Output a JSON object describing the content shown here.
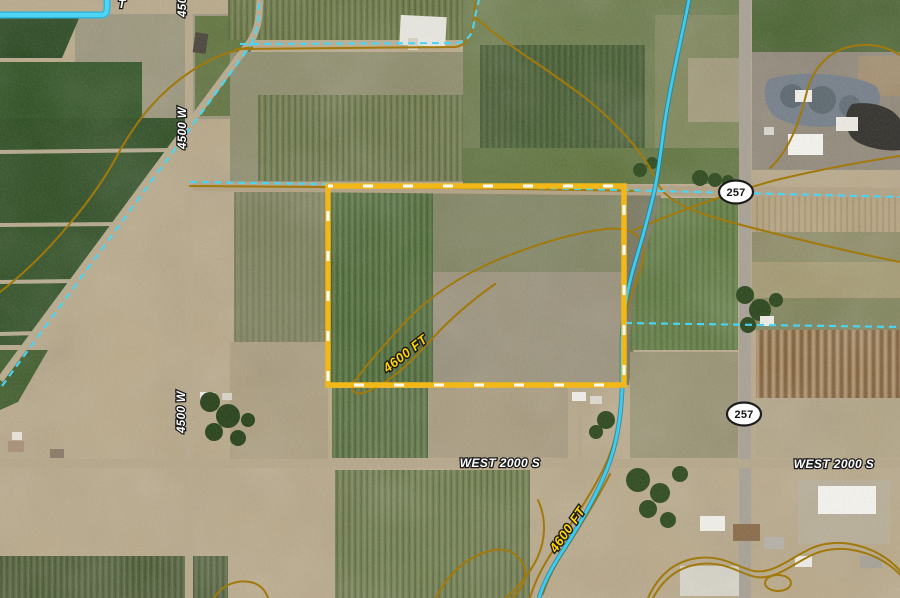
{
  "map": {
    "view": "aerial-satellite-parcel",
    "labels": {
      "vertical_road": "4500 W",
      "horizontal_road": "WEST 2000 S",
      "state_route": "257",
      "contour": "4600 FT",
      "partial_canal_label": "T"
    },
    "colors": {
      "parcel_outline": "#F2B818",
      "parcel_dash": "#FFFFFF",
      "contour_line": "#A1790C",
      "water_line": "#3BC8EE",
      "water_dashed": "#49D6F6",
      "road_label_fill": "#FFFFFF",
      "elevation_label_fill": "#FFD400",
      "shield_fill": "#FFFFFF",
      "shield_text": "#1A1A1A",
      "desert_base": "#B9A887"
    }
  }
}
